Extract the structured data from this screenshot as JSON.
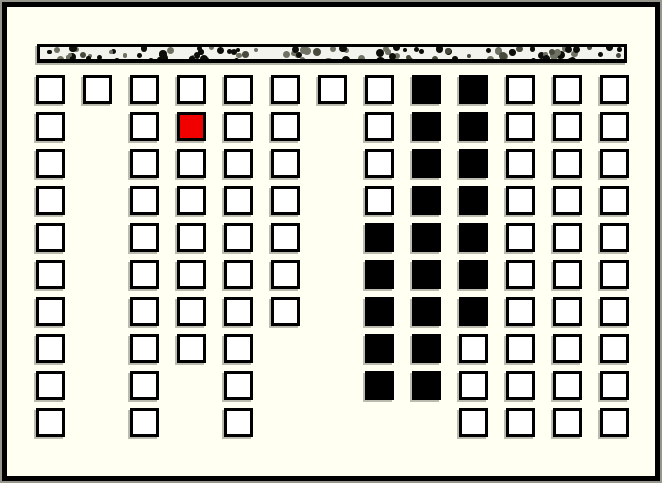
{
  "window": {
    "type": "seat-map",
    "background_color": "#fffff2",
    "frame_color": "#000000"
  },
  "screen_bar": {
    "fill_color": "#f3f3ee",
    "border_color": "#000000",
    "dot_colors": [
      "#0d0d09",
      "#6d7263",
      "#464b3c"
    ],
    "dot_color_weights": [
      0.55,
      0.3,
      0.15
    ],
    "dot_count": 110,
    "seed": 42
  },
  "seat_map": {
    "rows": 10,
    "columns": 13,
    "states": {
      "A": "available",
      "O": "occupied",
      "S": "selected",
      ".": "none"
    },
    "colors": {
      "available": "#ffffff",
      "occupied": "#000000",
      "selected": "#f10000"
    },
    "counts": {
      "available": 83,
      "occupied": 21,
      "selected": 1,
      "total": 105
    },
    "layout": [
      "AAAAAAAAOOAAA",
      "A.ASAA.AOOAAA",
      "A.AAAA.AOOAAA",
      "A.AAAA.AOOAAA",
      "A.AAAA.OOOAAA",
      "A.AAAA.OOOAAA",
      "A.AAAA.OOOAAA",
      "A.AAA..OOAAAA",
      "A.A.A..OOAAAA",
      "A.A.A....AAAA"
    ]
  }
}
